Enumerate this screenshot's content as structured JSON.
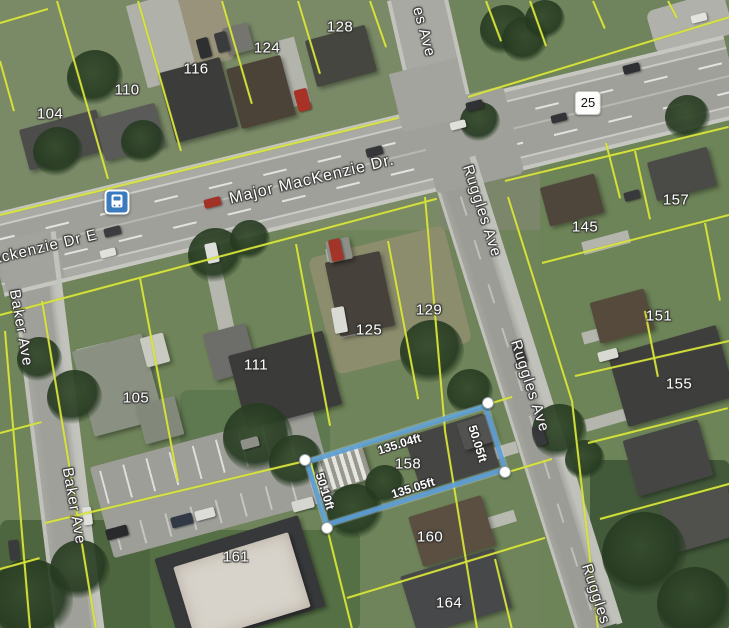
{
  "map": {
    "street_labels": [
      {
        "id": "major-mackenzie-dr",
        "text": "Major MacKenzie Dr."
      },
      {
        "id": "mackenzie-dr-e",
        "text": "ackenzie Dr E"
      },
      {
        "id": "baker-ave-upper",
        "text": "Baker Ave"
      },
      {
        "id": "baker-ave-lower",
        "text": "Baker Ave"
      },
      {
        "id": "ave-top-partial",
        "text": "es Ave"
      },
      {
        "id": "ruggles-ave-upper",
        "text": "Ruggles Ave"
      },
      {
        "id": "ruggles-ave-mid",
        "text": "Ruggles Ave"
      },
      {
        "id": "ruggles-ave-bottom",
        "text": "Ruggles Ave"
      }
    ],
    "highway_shield": {
      "number": "25"
    },
    "transit_stop": {
      "type": "bus-stop"
    },
    "house_numbers": [
      {
        "value": "104"
      },
      {
        "value": "110"
      },
      {
        "value": "116"
      },
      {
        "value": "124"
      },
      {
        "value": "128"
      },
      {
        "value": "105"
      },
      {
        "value": "111"
      },
      {
        "value": "125"
      },
      {
        "value": "129"
      },
      {
        "value": "145"
      },
      {
        "value": "157"
      },
      {
        "value": "151"
      },
      {
        "value": "155"
      },
      {
        "value": "158"
      },
      {
        "value": "160"
      },
      {
        "value": "161"
      },
      {
        "value": "164"
      }
    ],
    "selected_lot": {
      "house_number": "158",
      "front_dimension": "135.04ft",
      "rear_dimension": "135.05ft",
      "east_side_dimension": "50.05ft",
      "west_side_dimension": "50.10ft",
      "outline_color": "#5f9fd6"
    },
    "colors": {
      "parcel_line": "#d8e53c",
      "lot_outline": "#5f9fd6",
      "transit_icon": "#3a7bbf"
    }
  }
}
